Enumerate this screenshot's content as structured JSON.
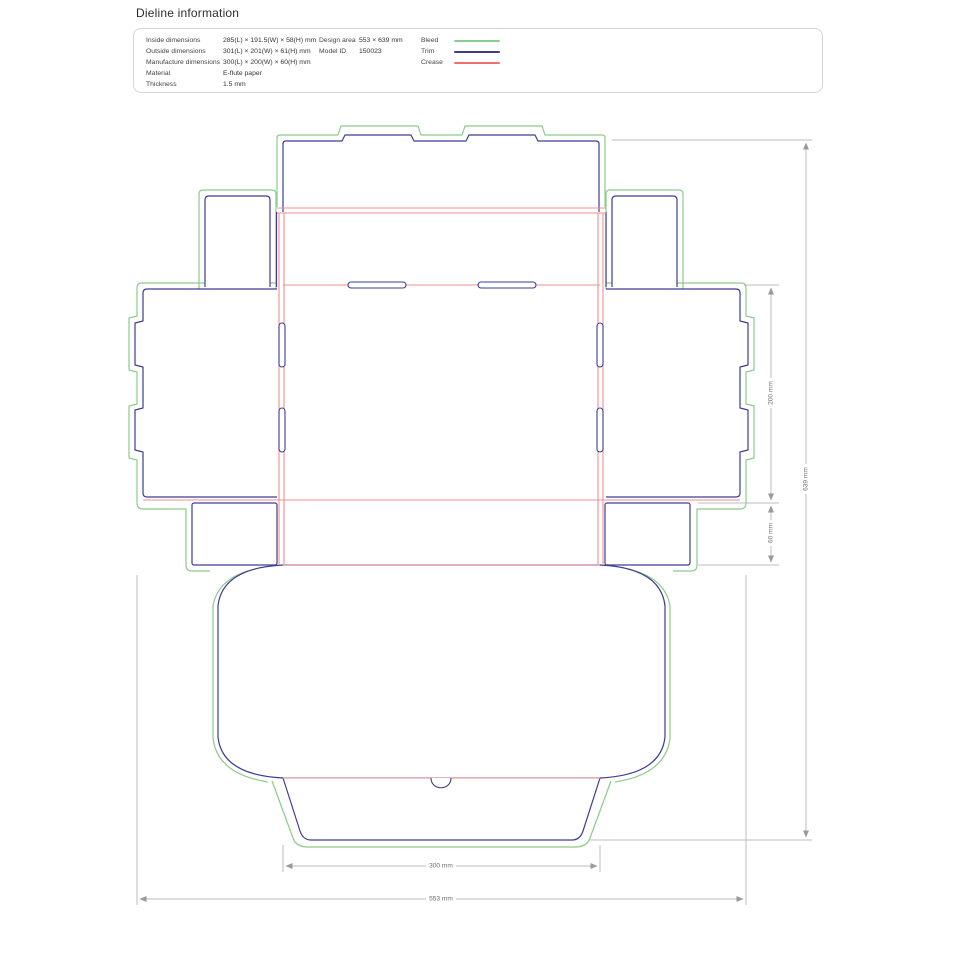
{
  "page": {
    "title": "Dieline information"
  },
  "info_panel": {
    "rows": [
      {
        "label": "Inside dimensions",
        "value": "285(L) × 191.5(W) × 58(H) mm"
      },
      {
        "label": "Outside dimensions",
        "value": "301(L) × 201(W) × 61(H) mm"
      },
      {
        "label": "Manufacture dimensions",
        "value": "300(L) × 200(W) × 60(H) mm"
      },
      {
        "label": "Material",
        "value": "E-flute paper"
      },
      {
        "label": "Thickness",
        "value": "1.5 mm"
      }
    ],
    "meta": [
      {
        "label": "Design area",
        "value": "553 × 639 mm"
      },
      {
        "label": "Model ID",
        "value": "150023"
      }
    ],
    "legend": [
      {
        "label": "Bleed",
        "color": "#8ccb8c"
      },
      {
        "label": "Trim",
        "color": "#3d3d94"
      },
      {
        "label": "Crease",
        "color": "#ee7070"
      }
    ]
  },
  "dimensions": {
    "inner_width": "300 mm",
    "outer_width": "553 mm",
    "panel_height": "200 mm",
    "wall_height": "60 mm",
    "outer_height": "639 mm"
  },
  "colors": {
    "bleed": "#8ccb8c",
    "trim": "#3d3d94",
    "crease": "#f09090",
    "dimension_line": "#bcbcbc"
  }
}
